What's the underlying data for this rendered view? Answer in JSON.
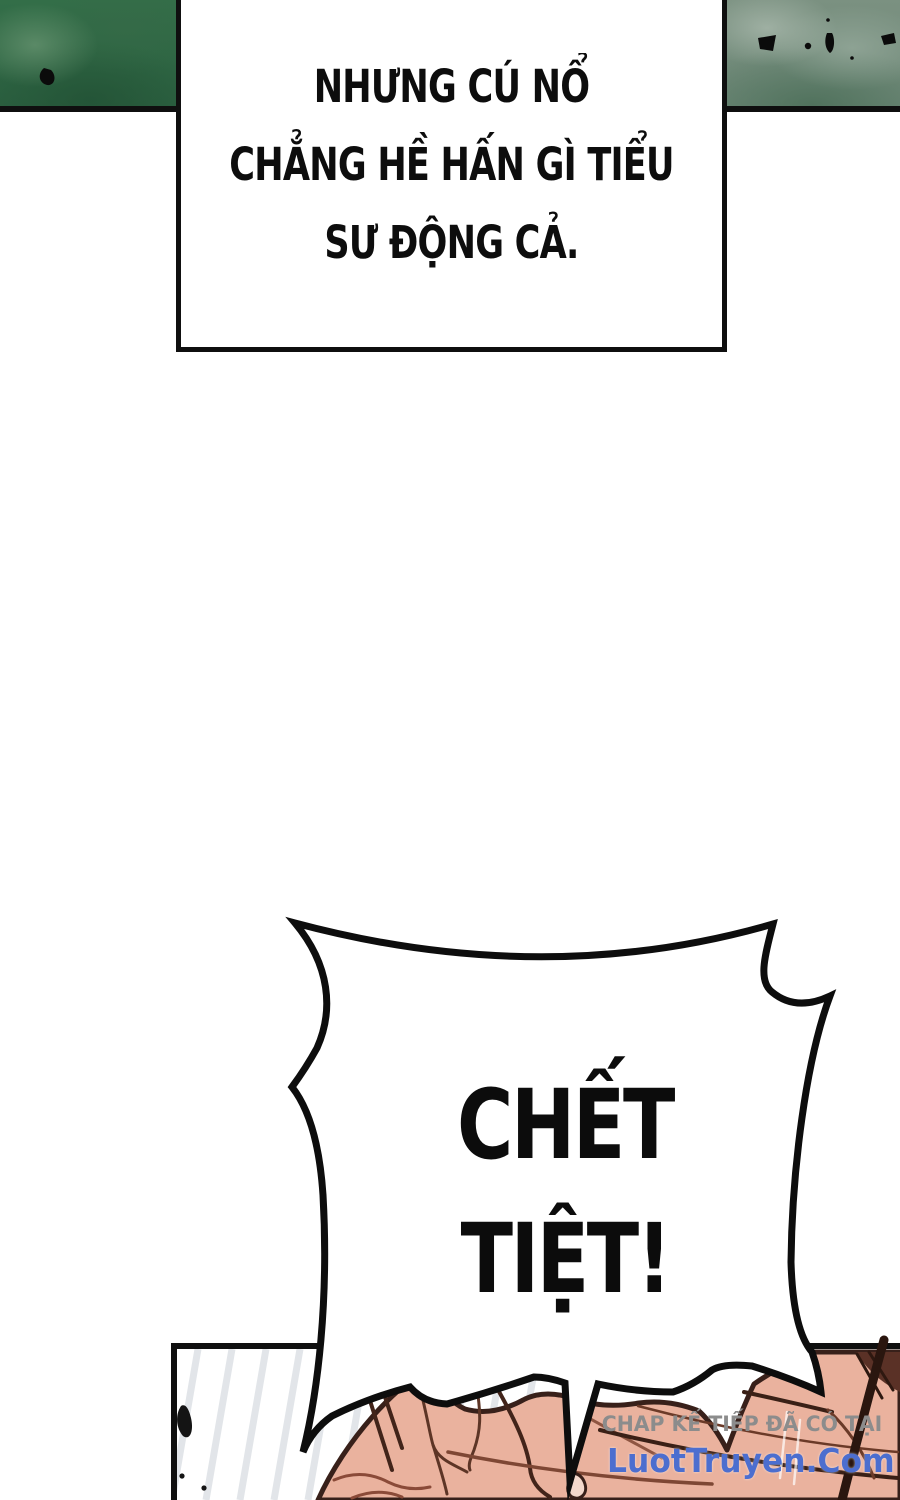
{
  "narration_box": {
    "lines": [
      "NHƯNG CÚ NỔ",
      "CHẲNG HỀ HẤN GÌ TIỂU",
      "SƯ ĐỘNG CẢ."
    ]
  },
  "speech_bubble": {
    "lines": [
      "CHẾT",
      "TIỆT!"
    ]
  },
  "watermark": {
    "line1": "CHAP KẾ TIẾP ĐÃ CÓ TẠI",
    "line2": "LuotTruyen.Com",
    "line1_color": "#8c8c8c",
    "line2_color": "#4c6ecf"
  },
  "colors": {
    "page_background": "#ffffff",
    "panel_border": "#0f0f0f",
    "green_panel_left": "#336e48",
    "green_panel_right": "#7b9181",
    "flesh": "#eab29e",
    "flesh_outline": "#38201a",
    "ink_speck": "#141414"
  }
}
